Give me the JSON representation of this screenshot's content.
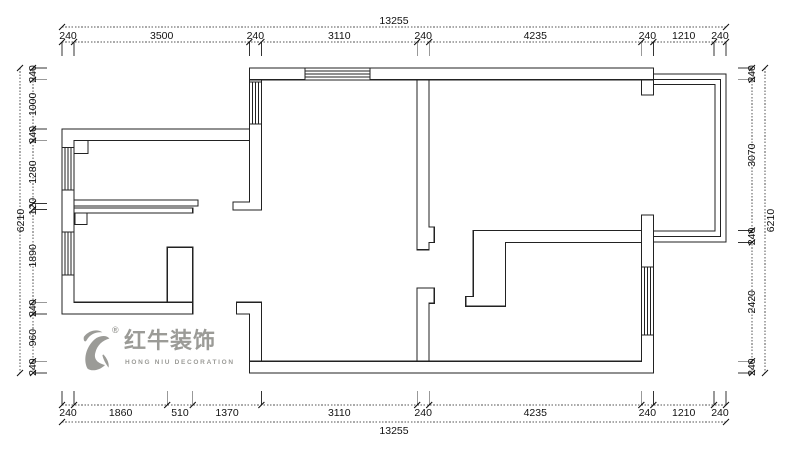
{
  "colors": {
    "line": "#222222",
    "text": "#111111",
    "logo": "#9b9b97",
    "background": "#ffffff"
  },
  "logo": {
    "brand_cn": "红牛装饰",
    "brand_en": "HONG NIU DECORATION",
    "registered_mark": "®"
  },
  "dimensions": {
    "top": {
      "total": "13255",
      "segments": [
        240,
        3500,
        240,
        3110,
        240,
        4235,
        240,
        1210,
        240
      ]
    },
    "bottom": {
      "total": "13255",
      "segments": [
        240,
        1860,
        510,
        1370,
        3110,
        240,
        4235,
        240,
        1210,
        240
      ]
    },
    "left": {
      "total": "6210",
      "segments": [
        240,
        1000,
        240,
        1280,
        120,
        1890,
        240,
        960,
        240
      ]
    },
    "right": {
      "total": "6210",
      "segments": [
        240,
        3070,
        240,
        2420,
        240
      ]
    }
  },
  "plan": {
    "extent_mm": {
      "width": 13255,
      "height": 6210
    },
    "walls": [
      {
        "name": "top-wall",
        "rect": [
          3740,
          0,
          8065,
          240
        ]
      },
      {
        "name": "top-right-pier",
        "rect": [
          11565,
          240,
          240,
          310
        ]
      },
      {
        "name": "kitchen-living-wall",
        "points": [
          [
            3740,
            240
          ],
          [
            3980,
            240
          ],
          [
            3980,
            2890
          ],
          [
            3415,
            2890
          ],
          [
            3415,
            2730
          ],
          [
            3740,
            2730
          ]
        ]
      },
      {
        "name": "left-wing-outer-wall",
        "points": [
          [
            0,
            1240
          ],
          [
            3740,
            1240
          ],
          [
            3740,
            1480
          ],
          [
            240,
            1480
          ],
          [
            240,
            4770
          ],
          [
            2610,
            4770
          ],
          [
            2610,
            5010
          ],
          [
            0,
            5010
          ]
        ]
      },
      {
        "name": "kitchen-corner-nub",
        "rect": [
          240,
          1480,
          280,
          260
        ]
      },
      {
        "name": "mid-thin-wall-upper",
        "rect": [
          240,
          2690,
          2475,
          120
        ]
      },
      {
        "name": "mid-thin-wall-lower",
        "rect": [
          240,
          2850,
          2370,
          100
        ]
      },
      {
        "name": "lower-left-nub",
        "rect": [
          260,
          2950,
          240,
          240
        ]
      },
      {
        "name": "left-wing-pier",
        "rect": [
          2100,
          3650,
          510,
          1120
        ]
      },
      {
        "name": "entry-pier",
        "points": [
          [
            3480,
            4770
          ],
          [
            3980,
            4770
          ],
          [
            3980,
            5970
          ],
          [
            3740,
            5970
          ],
          [
            3740,
            5010
          ],
          [
            3480,
            5010
          ]
        ]
      },
      {
        "name": "bottom-right-outer-wall",
        "points": [
          [
            11565,
            2990
          ],
          [
            11805,
            2990
          ],
          [
            11805,
            6210
          ],
          [
            3740,
            6210
          ],
          [
            3740,
            5970
          ],
          [
            11565,
            5970
          ]
        ]
      },
      {
        "name": "middle-wall-upper",
        "points": [
          [
            7090,
            240
          ],
          [
            7330,
            240
          ],
          [
            7330,
            3240
          ],
          [
            7430,
            3240
          ],
          [
            7430,
            3550
          ],
          [
            7330,
            3550
          ],
          [
            7330,
            3700
          ],
          [
            7090,
            3700
          ]
        ]
      },
      {
        "name": "middle-wall-lower",
        "points": [
          [
            7090,
            4480
          ],
          [
            7430,
            4480
          ],
          [
            7430,
            4790
          ],
          [
            7330,
            4790
          ],
          [
            7330,
            5970
          ],
          [
            7090,
            5970
          ]
        ]
      },
      {
        "name": "wardrobe-gamma-wall",
        "points": [
          [
            8210,
            3310
          ],
          [
            11565,
            3310
          ],
          [
            11565,
            3550
          ],
          [
            8850,
            3550
          ],
          [
            8850,
            4850
          ],
          [
            8060,
            4850
          ],
          [
            8060,
            4650
          ],
          [
            8210,
            4650
          ]
        ]
      }
    ],
    "windows": [
      {
        "name": "window-top",
        "rect": [
          4850,
          0,
          1300,
          240
        ],
        "o": "h"
      },
      {
        "name": "window-kitchen-east",
        "rect": [
          3740,
          280,
          240,
          860
        ],
        "o": "v"
      },
      {
        "name": "window-left-upper",
        "rect": [
          0,
          1620,
          240,
          860
        ],
        "o": "v"
      },
      {
        "name": "window-left-lower",
        "rect": [
          0,
          3340,
          240,
          870
        ],
        "o": "v"
      },
      {
        "name": "window-right",
        "rect": [
          11565,
          4050,
          240,
          1385
        ],
        "o": "v"
      }
    ],
    "balcony_railing": {
      "x": 11805,
      "top": 120,
      "right": 13255,
      "bottom": 3540,
      "count": 3,
      "inset": 110
    }
  }
}
